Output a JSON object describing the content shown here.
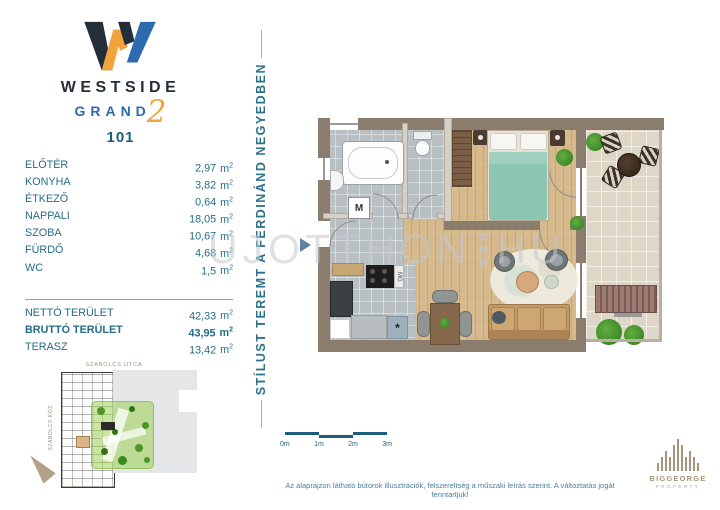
{
  "brand": {
    "name": "WESTSIDE",
    "series": "GRAND",
    "series_number": "2",
    "unit_number": "101"
  },
  "motto": "STÍLUST TEREMT A FERDINÁND NEGYEDBEN",
  "area_unit": "m",
  "area_sup": "2",
  "rooms": [
    {
      "label": "ELŐTÉR",
      "value": "2,97"
    },
    {
      "label": "KONYHA",
      "value": "3,82"
    },
    {
      "label": "ÉTKEZŐ",
      "value": "0,64"
    },
    {
      "label": "NAPPALI",
      "value": "18,05"
    },
    {
      "label": "SZOBA",
      "value": "10,67"
    },
    {
      "label": "FÜRDŐ",
      "value": "4,68"
    },
    {
      "label": "WC",
      "value": "1,5"
    }
  ],
  "totals": [
    {
      "label": "NETTÓ TERÜLET",
      "value": "42,33"
    },
    {
      "label": "BRUTTÓ TERÜLET",
      "value": "43,95"
    },
    {
      "label": "TERASZ",
      "value": "13,42"
    }
  ],
  "floorplan": {
    "washer_label": "M",
    "dishwasher_label": "MG",
    "fridge_label": "*"
  },
  "watermark": {
    "text_left": "UJOTTHON",
    "text_right": "HU"
  },
  "siteplan": {
    "street_top": "SZABOLCS UTCA",
    "street_left": "SZABOLCS KÖZ"
  },
  "scalebar": {
    "labels": [
      "0m",
      "1m",
      "2m",
      "3m"
    ]
  },
  "disclaimer": "Az alaprajzon látható bútorok illusztrációk, felszereltség a műszaki leírás szerint. A változtatás jogát fenntartjuk!",
  "developer": {
    "name": "BIGGEORGE",
    "subtitle": "PROPERTY"
  },
  "colors": {
    "teal": "#266b88",
    "dark_teal": "#1d5f7a",
    "orange": "#f2a43c",
    "navy": "#232e39",
    "blue": "#2d6ab0",
    "wall": "#8a7d6d",
    "taupe": "#a6957d"
  }
}
